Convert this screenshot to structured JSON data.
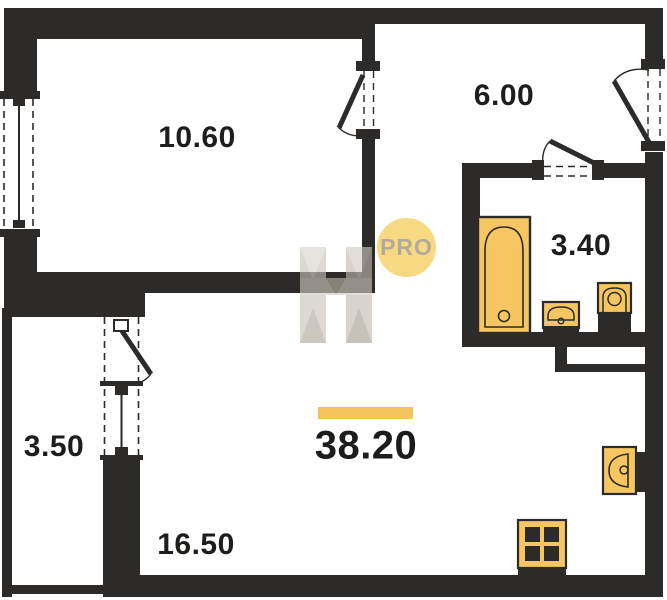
{
  "plan": {
    "rooms": [
      {
        "area": "10.60"
      },
      {
        "area": "6.00"
      },
      {
        "area": "3.40"
      },
      {
        "area": "3.50"
      },
      {
        "area": "16.50"
      }
    ],
    "total": {
      "area": "38.20"
    },
    "watermark": {
      "badge_text": "PRO"
    },
    "colors": {
      "wall": "#2d2b29",
      "fixture_fill": "#f5c661",
      "accent_bar": "#f2c55c",
      "badge_fill": "#f8d983",
      "badge_text": "#b3ab9a",
      "label_text": "#1d1d1b",
      "watermark_gray": "#c8c2b7"
    }
  }
}
